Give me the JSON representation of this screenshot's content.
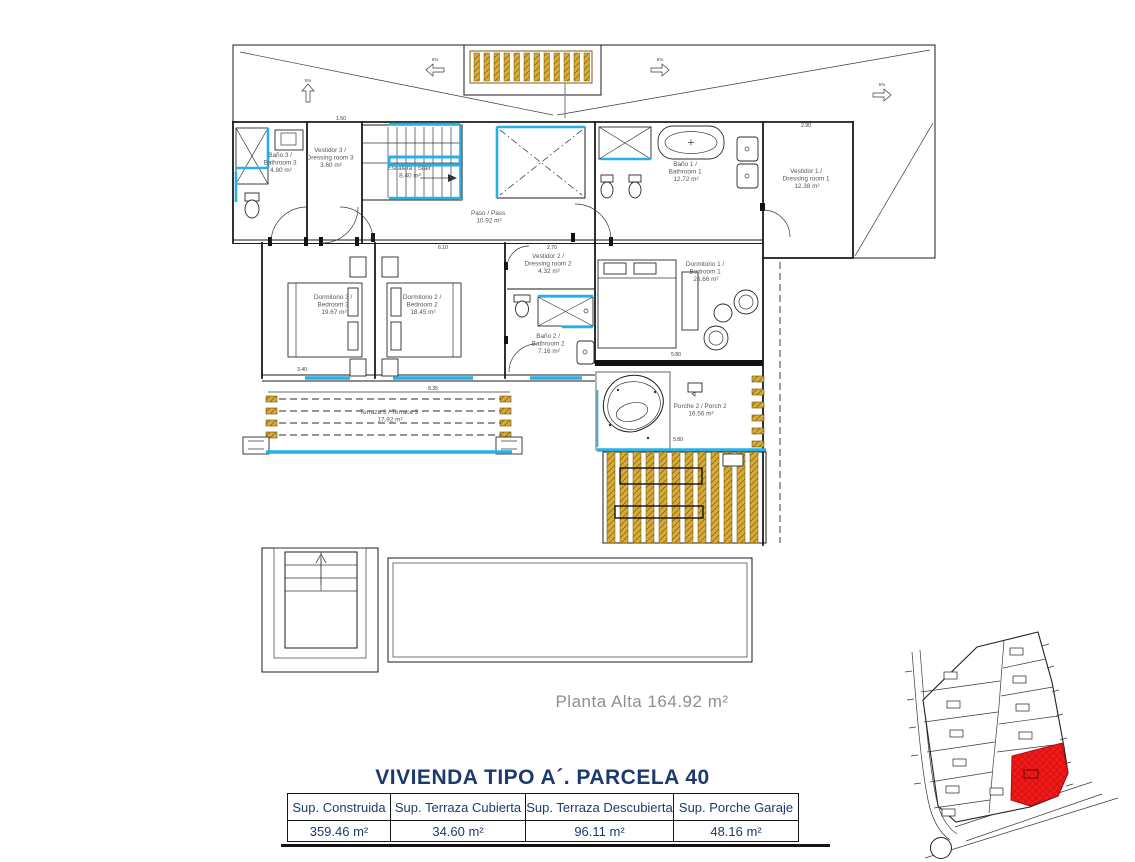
{
  "sheet": {
    "caption": "Planta Alta 164.92 m²",
    "title": "VIVIENDA TIPO A´. PARCELA 40"
  },
  "table": {
    "headers": [
      "Sup. Construida",
      "Sup. Terraza Cubierta",
      "Sup. Terraza Descubierta",
      "Sup. Porche Garaje"
    ],
    "values": [
      "359.46 m²",
      "34.60 m²",
      "96.11 m²",
      "48.16 m²"
    ]
  },
  "rooms": [
    {
      "lines": [
        "Baño 3 /",
        "Bathroom 3",
        "4.80 m²"
      ]
    },
    {
      "lines": [
        "Vestidor 3 /",
        "Dressing room 3",
        "3.60 m²"
      ]
    },
    {
      "lines": [
        "Escalera / Stair",
        "8.40 m²"
      ]
    },
    {
      "lines": [
        "Paso / Pass",
        "10.92 m²"
      ]
    },
    {
      "lines": [
        "Baño 1 /",
        "Bathroom 1",
        "12.72 m²"
      ]
    },
    {
      "lines": [
        "Vestidor 1 /",
        "Dressing room 1",
        "12.38 m²"
      ]
    },
    {
      "lines": [
        "Dormitorio 3 /",
        "Bedroom 3",
        "19.67 m²"
      ]
    },
    {
      "lines": [
        "Dormitorio 2 /",
        "Bedroom 2",
        "18.45 m²"
      ]
    },
    {
      "lines": [
        "Vestidor 2 /",
        "Dressing room 2",
        "4.32 m²"
      ]
    },
    {
      "lines": [
        "Baño 2 /",
        "Bathroom 2",
        "7.16 m²"
      ]
    },
    {
      "lines": [
        "Dormitorio 1 /",
        "Bedroom 1",
        "26.66 m²"
      ]
    },
    {
      "lines": [
        "Porche 2 / Porch 2",
        "16.56 m²"
      ]
    },
    {
      "lines": [
        "Terraza 3 / Terrace 3",
        "17.92 m²"
      ]
    }
  ],
  "dimensions": [
    "1.50",
    "2.90",
    "6.10",
    "2.70",
    "8.35",
    "5.80",
    "5.80",
    "3.40"
  ],
  "labels": {
    "slope": "5%"
  },
  "colors": {
    "accent_cyan": "#29b1e7",
    "wood_gold": "#d7ab3a",
    "parcel_red": "#ee1b1b",
    "title_navy": "#1d3a6e",
    "caption_gray": "#8f8f8f"
  }
}
